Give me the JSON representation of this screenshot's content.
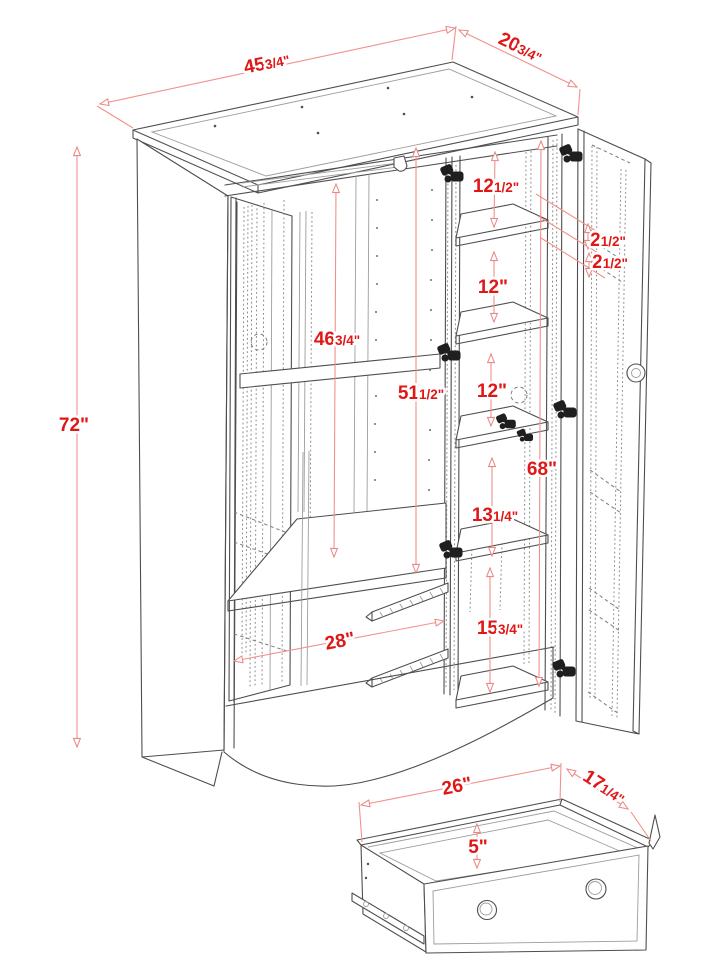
{
  "diagram_title": "Wardrobe armoire dimension diagram",
  "colors": {
    "dimension_text": "#e01717",
    "dimension_line": "#f1918c",
    "drawing_line": "#4e4e4e",
    "background": "#ffffff"
  },
  "dims": {
    "top_width": {
      "big": "45",
      "small": "3/4\""
    },
    "top_depth": {
      "big": "20",
      "small": "3/4\""
    },
    "overall_height": {
      "big": "72\"",
      "small": ""
    },
    "hanging_interior_height": {
      "big": "46",
      "small": "3/4\""
    },
    "center_interior_height": {
      "big": "51",
      "small": "1/2\""
    },
    "shelf_space_top": {
      "big": "12",
      "small": "1/2\""
    },
    "shelf_space_2": {
      "big": "12\"",
      "small": ""
    },
    "shelf_space_3": {
      "big": "12\"",
      "small": ""
    },
    "door_gap_upper": {
      "big": "2",
      "small": "1/2\""
    },
    "door_gap_lower": {
      "big": "2",
      "small": "1/2\""
    },
    "right_interior_height": {
      "big": "68\"",
      "small": ""
    },
    "shelf_space_4": {
      "big": "13",
      "small": "1/4\""
    },
    "bottom_space": {
      "big": "15",
      "small": "3/4\""
    },
    "drawer_opening_width": {
      "big": "28\"",
      "small": ""
    },
    "drawer_width": {
      "big": "26\"",
      "small": ""
    },
    "drawer_depth": {
      "big": "17",
      "small": "1/4\""
    },
    "drawer_height": {
      "big": "5\"",
      "small": ""
    }
  }
}
